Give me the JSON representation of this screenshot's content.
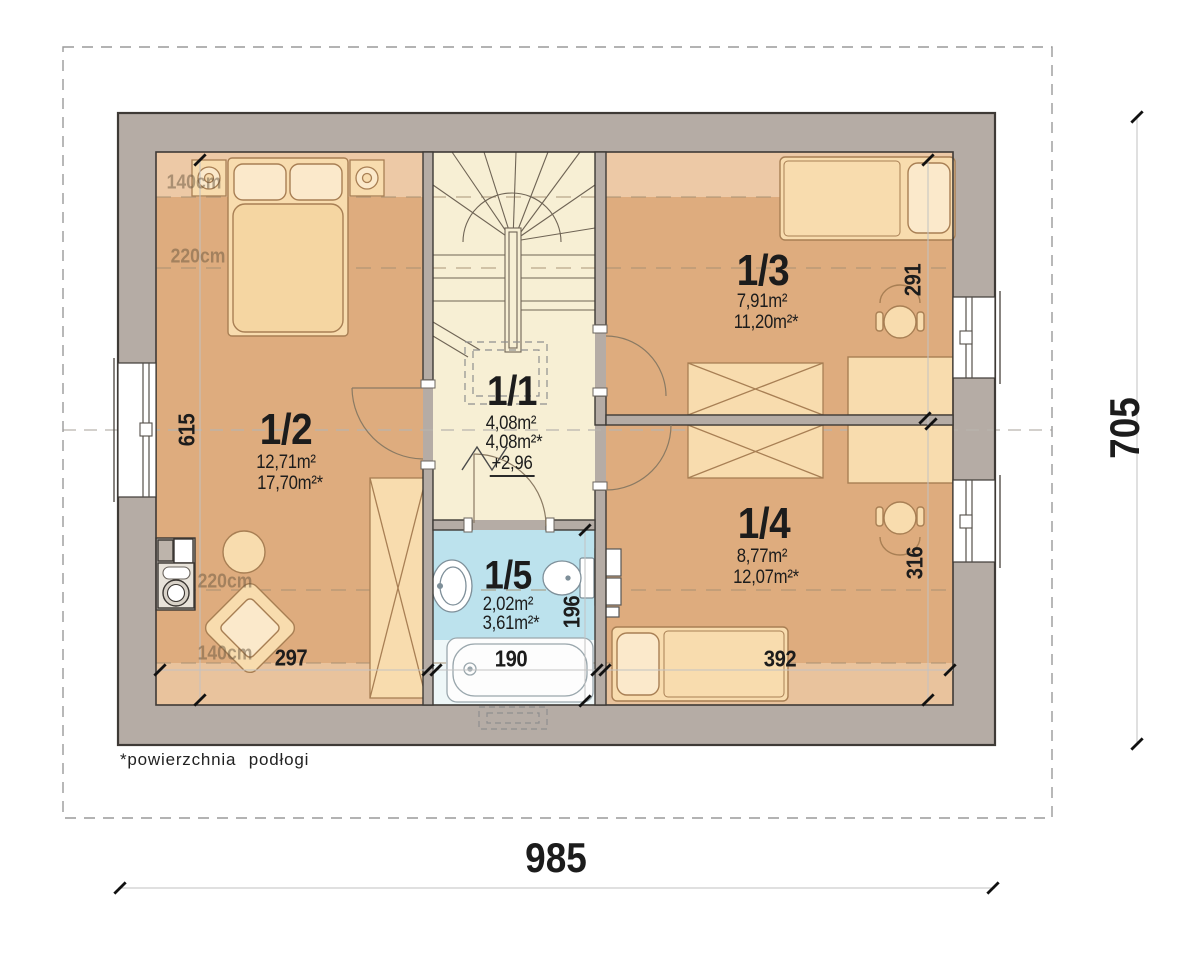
{
  "plan": {
    "footnote": "*powierzchnia podłogi",
    "rooms": [
      {
        "number": "1/1",
        "area_usable": "4,08m²",
        "area_floor": "4,08m²*",
        "floor_level": "+2,96"
      },
      {
        "number": "1/2",
        "area_usable": "12,71m²",
        "area_floor": "17,70m²*"
      },
      {
        "number": "1/3",
        "area_usable": "7,91m²",
        "area_floor": "11,20m²*"
      },
      {
        "number": "1/4",
        "area_usable": "8,77m²",
        "area_floor": "12,07m²*"
      },
      {
        "number": "1/5",
        "area_usable": "2,02m²",
        "area_floor": "3,61m²*"
      }
    ],
    "dimensions": {
      "overall_width": "985",
      "overall_depth": "705",
      "room2_depth": "615",
      "room2_width": "297",
      "bath_width": "190",
      "room4_width": "392",
      "bath_depth": "196",
      "room3_depth": "291",
      "room4_depth": "316"
    },
    "ceiling_height_lines": [
      "140cm",
      "220cm",
      "220cm",
      "140cm"
    ],
    "colors": {
      "wall": "#b5aca5",
      "room_floor": "#deac7e",
      "hall_floor": "#f7efd4",
      "bath_floor": "#bce2ed",
      "furniture": "#f8dcae",
      "height_line": "#a59072"
    }
  }
}
